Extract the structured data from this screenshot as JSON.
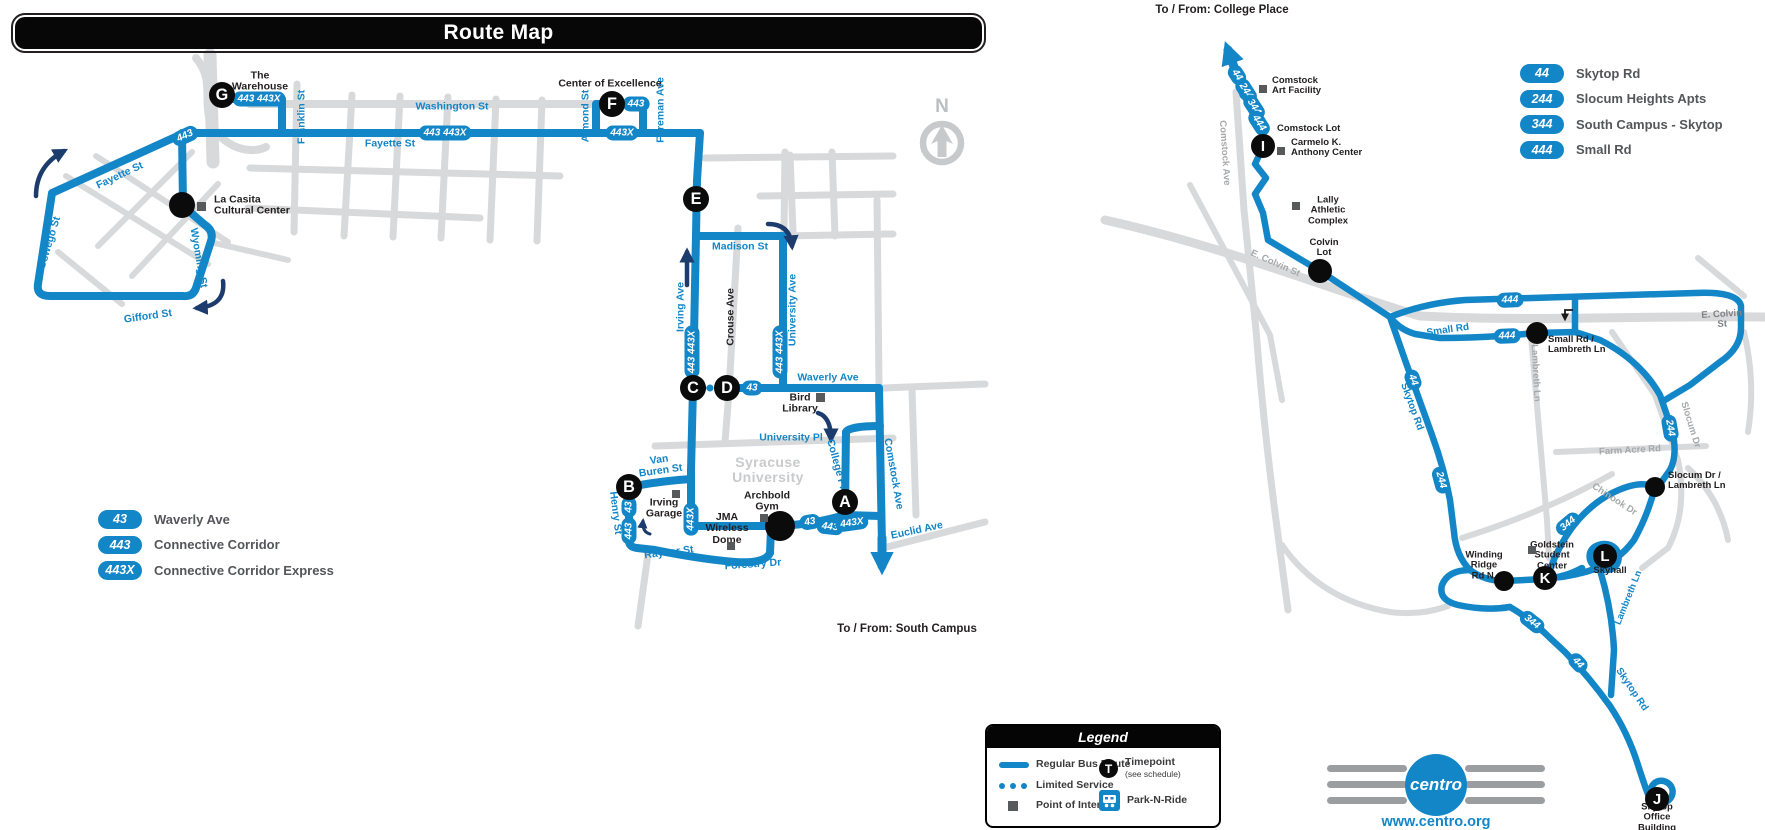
{
  "title": "Route Map",
  "compass": {
    "label": "N"
  },
  "colors": {
    "route_blue": "#1386c7",
    "navy": "#1d3c6e",
    "road_gray": "#d8d9da",
    "poi_gray": "#58595b",
    "timepoint_black": "#0b0b0b",
    "legend_text": "#54565a"
  },
  "left_legend": [
    {
      "badge": "43",
      "label": "Waverly Ave"
    },
    {
      "badge": "443",
      "label": "Connective Corridor"
    },
    {
      "badge": "443X",
      "label": "Connective Corridor Express"
    }
  ],
  "right_legend": [
    {
      "badge": "44",
      "label": "Skytop Rd"
    },
    {
      "badge": "244",
      "label": "Slocum Heights Apts"
    },
    {
      "badge": "344",
      "label": "South Campus - Skytop"
    },
    {
      "badge": "444",
      "label": "Small Rd"
    }
  ],
  "legend_box": {
    "title": "Legend",
    "regular": "Regular Bus Route",
    "limited": "Limited Service",
    "poi": "Point of Interest",
    "timepoint": "Timepoint",
    "timepoint_sub": "(see schedule)",
    "timepoint_letter": "T",
    "parknride": "Park-N-Ride"
  },
  "footer": {
    "logo": "centro",
    "website": "www.centro.org"
  },
  "map_labels": [
    {
      "name": "street-franklin",
      "text": "Franklin St",
      "x": 302,
      "y": 117,
      "rot": -90,
      "cls": "blue",
      "size": 10.5
    },
    {
      "name": "street-washington",
      "text": "Washington St",
      "x": 452,
      "y": 107,
      "rot": 0,
      "cls": "blue",
      "size": 10.5
    },
    {
      "name": "street-fayette-main",
      "text": "Fayette St",
      "x": 390,
      "y": 144,
      "rot": 0,
      "cls": "blue",
      "size": 10.5
    },
    {
      "name": "street-fayette-west",
      "text": "Fayette St",
      "x": 120,
      "y": 176,
      "rot": -25,
      "cls": "blue",
      "size": 10.5
    },
    {
      "name": "street-oswego",
      "text": "Oswego St",
      "x": 50,
      "y": 243,
      "rot": -73,
      "cls": "blue",
      "size": 10.5
    },
    {
      "name": "street-wyoming",
      "text": "Wyoming St",
      "x": 198,
      "y": 258,
      "rot": 80,
      "cls": "blue",
      "size": 10.5
    },
    {
      "name": "street-gifford",
      "text": "Gifford St",
      "x": 148,
      "y": 317,
      "rot": -8,
      "cls": "blue",
      "size": 10.5
    },
    {
      "name": "street-madison",
      "text": "Madison St",
      "x": 740,
      "y": 247,
      "rot": 0,
      "cls": "blue",
      "size": 10.5
    },
    {
      "name": "street-irving",
      "text": "Irving Ave",
      "x": 681,
      "y": 307,
      "rot": -90,
      "cls": "blue",
      "size": 10.5
    },
    {
      "name": "street-crouse",
      "text": "Crouse Ave",
      "x": 731,
      "y": 317,
      "rot": -90,
      "cls": "black-street",
      "size": 10.5
    },
    {
      "name": "street-university-ave",
      "text": "University Ave",
      "x": 793,
      "y": 310,
      "rot": -90,
      "cls": "blue",
      "size": 10.5
    },
    {
      "name": "street-waverly",
      "text": "Waverly Ave",
      "x": 828,
      "y": 378,
      "rot": 0,
      "cls": "blue",
      "size": 10.5
    },
    {
      "name": "street-university-pl",
      "text": "University Pl",
      "x": 791,
      "y": 438,
      "rot": 0,
      "cls": "blue",
      "size": 10.5
    },
    {
      "name": "street-van-buren",
      "text": "Van\nBuren St",
      "x": 660,
      "y": 466,
      "rot": -8,
      "cls": "blue",
      "size": 10.5
    },
    {
      "name": "street-henry",
      "text": "Henry St",
      "x": 615,
      "y": 513,
      "rot": 83,
      "cls": "blue",
      "size": 10.5
    },
    {
      "name": "street-raynor",
      "text": "Raynor St",
      "x": 669,
      "y": 553,
      "rot": -7,
      "cls": "blue",
      "size": 10.5
    },
    {
      "name": "street-forestry",
      "text": "Forestry Dr",
      "x": 753,
      "y": 565,
      "rot": -4,
      "cls": "blue",
      "size": 10.5
    },
    {
      "name": "street-college-pl",
      "text": "College Pl",
      "x": 836,
      "y": 464,
      "rot": 75,
      "cls": "blue",
      "size": 10.5
    },
    {
      "name": "street-comstock-left",
      "text": "Comstock Ave",
      "x": 893,
      "y": 474,
      "rot": 80,
      "cls": "blue",
      "size": 10.5
    },
    {
      "name": "street-euclid",
      "text": "Euclid Ave",
      "x": 917,
      "y": 531,
      "rot": -12,
      "cls": "blue",
      "size": 10.5
    },
    {
      "name": "street-almond",
      "text": "Almond St",
      "x": 586,
      "y": 116,
      "rot": -90,
      "cls": "blue",
      "size": 10.5
    },
    {
      "name": "street-foreman",
      "text": "Foreman Ave",
      "x": 661,
      "y": 110,
      "rot": -90,
      "cls": "blue",
      "size": 10.5
    },
    {
      "name": "campus-syracuse-university",
      "text": "Syracuse\nUniversity",
      "x": 768,
      "y": 470,
      "rot": 0,
      "cls": "campus",
      "size": 14
    },
    {
      "name": "street-comstock-right",
      "text": "Comstock Ave",
      "x": 1224,
      "y": 153,
      "rot": 86,
      "cls": "gray",
      "size": 9.5
    },
    {
      "name": "street-e-colvin-w",
      "text": "E. Colvin St",
      "x": 1275,
      "y": 264,
      "rot": 24,
      "cls": "gray",
      "size": 9.5
    },
    {
      "name": "street-e-colvin-e",
      "text": "E. Colvin St",
      "x": 1722,
      "y": 320,
      "rot": -3,
      "cls": "darkgray",
      "size": 9.5
    },
    {
      "name": "street-small-rd",
      "text": "Small Rd",
      "x": 1448,
      "y": 331,
      "rot": -8,
      "cls": "blue",
      "size": 10
    },
    {
      "name": "street-skytop-n",
      "text": "Skytop Rd",
      "x": 1411,
      "y": 407,
      "rot": 70,
      "cls": "blue",
      "size": 10
    },
    {
      "name": "street-farm-acre",
      "text": "Farm Acre Rd",
      "x": 1630,
      "y": 451,
      "rot": -3,
      "cls": "gray",
      "size": 9.5
    },
    {
      "name": "street-chinook",
      "text": "Chinook Dr",
      "x": 1614,
      "y": 500,
      "rot": 33,
      "cls": "gray",
      "size": 9.5
    },
    {
      "name": "street-slocum",
      "text": "Slocum Dr",
      "x": 1690,
      "y": 425,
      "rot": 73,
      "cls": "gray",
      "size": 9.5
    },
    {
      "name": "street-lambreth-gray",
      "text": "Lambreth Ln",
      "x": 1535,
      "y": 373,
      "rot": 87,
      "cls": "gray",
      "size": 9.5
    },
    {
      "name": "street-lambreth-blue",
      "text": "Lambreth Ln",
      "x": 1629,
      "y": 598,
      "rot": -68,
      "cls": "blue",
      "size": 9.5
    },
    {
      "name": "street-skytop-s",
      "text": "Skytop Rd",
      "x": 1631,
      "y": 690,
      "rot": 56,
      "cls": "blue",
      "size": 10
    },
    {
      "name": "poi-label-warehouse",
      "text": "The\nWarehouse",
      "x": 260,
      "y": 82,
      "rot": 0,
      "cls": "poi",
      "size": 10.5
    },
    {
      "name": "poi-label-center-of-excellence",
      "text": "Center of Excellence",
      "x": 610,
      "y": 84,
      "rot": 0,
      "cls": "poi",
      "size": 10.5
    },
    {
      "name": "poi-label-la-casita",
      "text": "La Casita\nCultural Center",
      "x": 214,
      "y": 206,
      "rot": 0,
      "cls": "poi",
      "size": 10.5,
      "anchor": "left"
    },
    {
      "name": "poi-label-bird-library",
      "text": "Bird\nLibrary",
      "x": 800,
      "y": 404,
      "rot": 0,
      "cls": "poi",
      "size": 10.5
    },
    {
      "name": "poi-label-irving-garage",
      "text": "Irving\nGarage",
      "x": 664,
      "y": 509,
      "rot": 0,
      "cls": "poi",
      "size": 10.5
    },
    {
      "name": "poi-label-archbold",
      "text": "Archbold\nGym",
      "x": 767,
      "y": 502,
      "rot": 0,
      "cls": "poi",
      "size": 10.5
    },
    {
      "name": "poi-label-jma",
      "text": "JMA\nWireless\nDome",
      "x": 727,
      "y": 529,
      "rot": 0,
      "cls": "poi",
      "size": 10.5
    },
    {
      "name": "poi-label-comstock-art",
      "text": "Comstock\nArt Facility",
      "x": 1272,
      "y": 86,
      "rot": 0,
      "cls": "poi",
      "size": 9.5,
      "anchor": "left"
    },
    {
      "name": "poi-label-comstock-lot",
      "text": "Comstock Lot",
      "x": 1277,
      "y": 129,
      "rot": 0,
      "cls": "poi",
      "size": 9.5,
      "anchor": "left"
    },
    {
      "name": "poi-label-carmelo",
      "text": "Carmelo K.\nAnthony Center",
      "x": 1291,
      "y": 148,
      "rot": 0,
      "cls": "poi",
      "size": 9.5,
      "anchor": "left"
    },
    {
      "name": "poi-label-lally",
      "text": "Lally\nAthletic\nComplex",
      "x": 1328,
      "y": 211,
      "rot": 0,
      "cls": "poi",
      "size": 9.5
    },
    {
      "name": "poi-label-colvin-lot",
      "text": "Colvin\nLot",
      "x": 1324,
      "y": 248,
      "rot": 0,
      "cls": "poi",
      "size": 9.5
    },
    {
      "name": "poi-label-small-lambreth",
      "text": "Small Rd /\nLambreth Ln",
      "x": 1548,
      "y": 345,
      "rot": 0,
      "cls": "poi",
      "size": 9.5,
      "anchor": "left"
    },
    {
      "name": "poi-label-slocum-lambreth",
      "text": "Slocum Dr /\nLambreth Ln",
      "x": 1668,
      "y": 481,
      "rot": 0,
      "cls": "poi",
      "size": 9.5,
      "anchor": "left"
    },
    {
      "name": "poi-label-winding-ridge",
      "text": "Winding\nRidge\nRd N.",
      "x": 1484,
      "y": 566,
      "rot": 0,
      "cls": "poi",
      "size": 9.5
    },
    {
      "name": "poi-label-goldstein",
      "text": "Goldstein\nStudent\nCenter",
      "x": 1552,
      "y": 556,
      "rot": 0,
      "cls": "poi",
      "size": 9.5
    },
    {
      "name": "poi-label-skyhall",
      "text": "Skyhall",
      "x": 1610,
      "y": 571,
      "rot": 0,
      "cls": "poi",
      "size": 9.5
    },
    {
      "name": "poi-label-skytop-office",
      "text": "Skytop\nOffice\nBuilding",
      "x": 1657,
      "y": 818,
      "rot": 0,
      "cls": "poi",
      "size": 9.5
    },
    {
      "name": "note-college-place",
      "text": "To / From: College Place",
      "x": 1222,
      "y": 10,
      "rot": 0,
      "cls": "note",
      "size": 11.5
    },
    {
      "name": "note-south-campus",
      "text": "To / From: South Campus",
      "x": 907,
      "y": 629,
      "rot": 0,
      "cls": "note",
      "size": 11.5
    }
  ],
  "badges": [
    {
      "text": "443  443X",
      "x": 259,
      "y": 99,
      "rot": 0
    },
    {
      "text": "443",
      "x": 185,
      "y": 136,
      "rot": -25
    },
    {
      "text": "443  443X",
      "x": 445,
      "y": 133,
      "rot": 0
    },
    {
      "text": "443X",
      "x": 622,
      "y": 133,
      "rot": 0
    },
    {
      "text": "443",
      "x": 636,
      "y": 104,
      "rot": 0
    },
    {
      "text": "443  443X",
      "x": 692,
      "y": 352,
      "rot": -90
    },
    {
      "text": "443  443X",
      "x": 780,
      "y": 352,
      "rot": -90
    },
    {
      "text": "43",
      "x": 752,
      "y": 388,
      "rot": 0
    },
    {
      "text": "43",
      "x": 629,
      "y": 507,
      "rot": -90
    },
    {
      "text": "443",
      "x": 629,
      "y": 531,
      "rot": -90
    },
    {
      "text": "443X",
      "x": 691,
      "y": 519,
      "rot": -90
    },
    {
      "text": "43",
      "x": 810,
      "y": 522,
      "rot": -10
    },
    {
      "text": "443",
      "x": 830,
      "y": 527,
      "rot": 6
    },
    {
      "text": "443X",
      "x": 852,
      "y": 523,
      "rot": -8
    },
    {
      "text": "44",
      "x": 1237,
      "y": 75,
      "rot": 57
    },
    {
      "text": "244",
      "x": 1246,
      "y": 91,
      "rot": 57
    },
    {
      "text": "344",
      "x": 1254,
      "y": 107,
      "rot": 57
    },
    {
      "text": "444",
      "x": 1259,
      "y": 123,
      "rot": 57
    },
    {
      "text": "444",
      "x": 1510,
      "y": 300,
      "rot": -2
    },
    {
      "text": "444",
      "x": 1507,
      "y": 336,
      "rot": -2
    },
    {
      "text": "44",
      "x": 1413,
      "y": 380,
      "rot": 70
    },
    {
      "text": "244",
      "x": 1441,
      "y": 480,
      "rot": 75
    },
    {
      "text": "244",
      "x": 1670,
      "y": 428,
      "rot": 80
    },
    {
      "text": "344",
      "x": 1568,
      "y": 524,
      "rot": -40
    },
    {
      "text": "344",
      "x": 1532,
      "y": 622,
      "rot": 38
    },
    {
      "text": "44",
      "x": 1578,
      "y": 663,
      "rot": 47
    }
  ],
  "timepoints": [
    {
      "letter": "G",
      "x": 222,
      "y": 95,
      "r": 13
    },
    {
      "letter": "F",
      "x": 612,
      "y": 104,
      "r": 13
    },
    {
      "letter": "E",
      "x": 696,
      "y": 199,
      "r": 13
    },
    {
      "letter": "C",
      "x": 693,
      "y": 388,
      "r": 13
    },
    {
      "letter": "D",
      "x": 727,
      "y": 388,
      "r": 13
    },
    {
      "letter": "B",
      "x": 629,
      "y": 487,
      "r": 13
    },
    {
      "letter": "A",
      "x": 845,
      "y": 502,
      "r": 13
    },
    {
      "letter": "I",
      "x": 1263,
      "y": 146,
      "r": 12
    },
    {
      "letter": "K",
      "x": 1545,
      "y": 578,
      "r": 12
    },
    {
      "letter": "L",
      "x": 1605,
      "y": 556,
      "r": 12
    },
    {
      "letter": "J",
      "x": 1657,
      "y": 799,
      "r": 12
    }
  ],
  "dots": [
    {
      "name": "la-casita-stop",
      "x": 182,
      "y": 205,
      "r": 13
    },
    {
      "name": "archbold-stop",
      "x": 780,
      "y": 526,
      "r": 15
    },
    {
      "name": "colvin-lot-stop",
      "x": 1320,
      "y": 271,
      "r": 12
    },
    {
      "name": "small-rd-stop",
      "x": 1537,
      "y": 333,
      "r": 11
    },
    {
      "name": "slocum-lambreth-stop",
      "x": 1655,
      "y": 487,
      "r": 10
    },
    {
      "name": "winding-ridge-stop",
      "x": 1504,
      "y": 581,
      "r": 10
    }
  ],
  "pois": [
    {
      "name": "poi-la-casita",
      "x": 201,
      "y": 206,
      "s": 9
    },
    {
      "name": "poi-bird-library",
      "x": 820,
      "y": 397,
      "s": 9
    },
    {
      "name": "poi-irving-garage",
      "x": 676,
      "y": 494,
      "s": 8
    },
    {
      "name": "poi-archbold",
      "x": 764,
      "y": 518,
      "s": 8
    },
    {
      "name": "poi-jma",
      "x": 731,
      "y": 546,
      "s": 8
    },
    {
      "name": "poi-comstock-art",
      "x": 1263,
      "y": 89,
      "s": 8
    },
    {
      "name": "poi-carmelo",
      "x": 1281,
      "y": 151,
      "s": 8
    },
    {
      "name": "poi-lally",
      "x": 1296,
      "y": 206,
      "s": 8
    },
    {
      "name": "poi-goldstein",
      "x": 1532,
      "y": 550,
      "s": 8
    }
  ]
}
